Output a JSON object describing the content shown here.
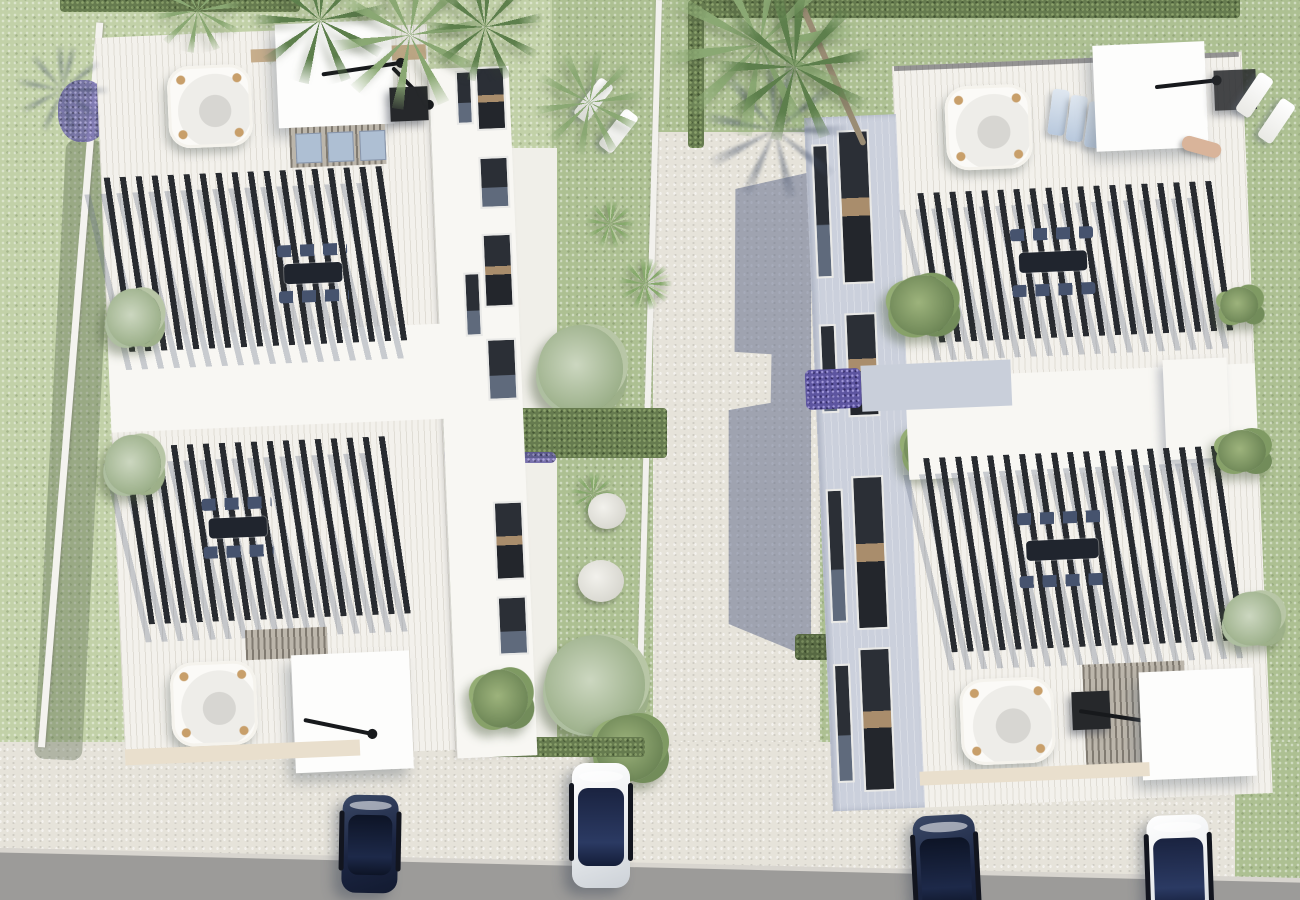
{
  "scene": {
    "type": "3d-architectural-aerial-render",
    "subject": "Top-down rendering of two modern white duplex villas with furnished rooftop terraces",
    "setting": "Two residential plots separated by a cobbled pedestrian lane, lawns with palms, hedges and shrubs, parking bays and an asphalt road along the bottom edge",
    "lighting": "Bright daylight with sun from the upper right casting blue-grey shadows toward the lower left"
  },
  "buildings": {
    "count": 2,
    "left_villa": {
      "features": [
        "striped roof deck",
        "2 hot tubs with tan corner trim",
        "2 white shade canopies",
        "2 black cantilever parasols",
        "2 black slatted pergolas",
        "2 outdoor dining sets",
        "louvered roof strip with 3 skylights",
        "glazed side facade",
        "planter shrubs"
      ]
    },
    "right_villa": {
      "features": [
        "striped roof deck",
        "2 hot tubs with tan corner trim",
        "2 white shade canopies",
        "2 black cantilever parasols",
        "2 black slatted pergolas",
        "2 outdoor dining sets",
        "3 blue sun loungers",
        "sunbathing person",
        "shaded glazed facade",
        "balcony volume",
        "lavender planting in recess"
      ]
    }
  },
  "landscape": {
    "street": "central cobbled lane with large cast building shadow",
    "hedges": 6,
    "palm_trees": 7,
    "shrubs": 12,
    "agaves": 4,
    "stepping_stones": 2,
    "lavender_patches": 3,
    "sun_loungers_on_grass": 4
  },
  "vehicles": {
    "count": 4,
    "list": [
      "navy car bottom-left",
      "white car with navy glass roof bottom-left",
      "navy car bottom-right",
      "white car with navy glass roof bottom-right"
    ]
  },
  "palette": {
    "grass": "#c2d1a8",
    "grass_olive": "#adc092",
    "cobble": "#e6e3da",
    "road": "#9c9b99",
    "building_white": "#f8f7f3",
    "deck": "#f3f1ec",
    "facade_shaded": "#cbd0dc",
    "pergola_slat": "#282b30",
    "window_glass": "#2b2f36",
    "hedge_green": "#667b4f",
    "lavender": "#5d55a0",
    "hot_tub_trim": "#c89f6a",
    "shadow_blue": "#586486",
    "car_navy": "#1b2542",
    "car_white": "#eef0f2"
  }
}
